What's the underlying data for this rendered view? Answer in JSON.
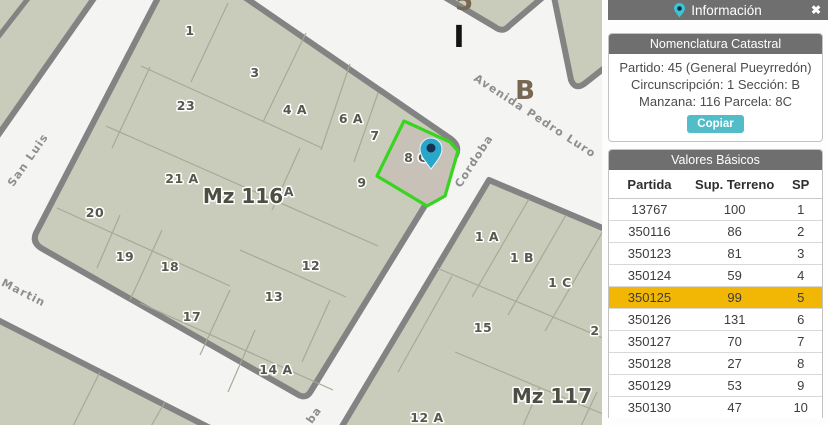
{
  "panel": {
    "header": {
      "title": "Información",
      "close_icon": "✖"
    },
    "nomenclatura": {
      "title": "Nomenclatura Catastral",
      "partido_line": "Partido: 45 (General Pueyrredón)",
      "circunscripcion_line": "Circunscripción: 1 Sección: B",
      "manzana_line": "Manzana: 116 Parcela: 8C",
      "copy_label": "Copiar"
    },
    "valores": {
      "title": "Valores Básicos",
      "columns": [
        "Partida",
        "Sup. Terreno",
        "SP"
      ],
      "rows": [
        [
          "13767",
          "100",
          "1"
        ],
        [
          "350116",
          "86",
          "2"
        ],
        [
          "350123",
          "81",
          "3"
        ],
        [
          "350124",
          "59",
          "4"
        ],
        [
          "350125",
          "99",
          "5"
        ],
        [
          "350126",
          "131",
          "6"
        ],
        [
          "350127",
          "70",
          "7"
        ],
        [
          "350128",
          "27",
          "8"
        ],
        [
          "350129",
          "53",
          "9"
        ],
        [
          "350130",
          "47",
          "10"
        ]
      ],
      "highlighted_partida": "350125"
    }
  },
  "map": {
    "selected_parcel_label": "8 C",
    "labels": [
      {
        "text": "1",
        "x": 190,
        "y": 35,
        "cls": "parcel",
        "name": "parcel-label-1"
      },
      {
        "text": "3",
        "x": 255,
        "y": 77,
        "cls": "parcel",
        "name": "parcel-label-3"
      },
      {
        "text": "23",
        "x": 186,
        "y": 110,
        "cls": "parcel",
        "name": "parcel-label-23"
      },
      {
        "text": "4 A",
        "x": 295,
        "y": 114,
        "cls": "parcel",
        "name": "parcel-label-4a"
      },
      {
        "text": "6 A",
        "x": 351,
        "y": 123,
        "cls": "parcel",
        "name": "parcel-label-6a"
      },
      {
        "text": "7",
        "x": 375,
        "y": 140,
        "cls": "parcel",
        "name": "parcel-label-7"
      },
      {
        "text": "8 C",
        "x": 416,
        "y": 162,
        "cls": "parcel",
        "name": "parcel-label-8c"
      },
      {
        "text": "9",
        "x": 362,
        "y": 187,
        "cls": "parcel",
        "name": "parcel-label-9"
      },
      {
        "text": "21 A",
        "x": 182,
        "y": 183,
        "cls": "parcel",
        "name": "parcel-label-21a"
      },
      {
        "text": "A",
        "x": 289,
        "y": 196,
        "cls": "parcel",
        "name": "parcel-label-a-partial"
      },
      {
        "text": "20",
        "x": 95,
        "y": 217,
        "cls": "parcel",
        "name": "parcel-label-20"
      },
      {
        "text": "19",
        "x": 125,
        "y": 261,
        "cls": "parcel",
        "name": "parcel-label-19"
      },
      {
        "text": "18",
        "x": 170,
        "y": 271,
        "cls": "parcel",
        "name": "parcel-label-18"
      },
      {
        "text": "12",
        "x": 311,
        "y": 270,
        "cls": "parcel",
        "name": "parcel-label-12"
      },
      {
        "text": "13",
        "x": 274,
        "y": 301,
        "cls": "parcel",
        "name": "parcel-label-13"
      },
      {
        "text": "17",
        "x": 192,
        "y": 321,
        "cls": "parcel",
        "name": "parcel-label-17"
      },
      {
        "text": "14 A",
        "x": 276,
        "y": 374,
        "cls": "parcel",
        "name": "parcel-label-14a"
      },
      {
        "text": "1 A",
        "x": 487,
        "y": 241,
        "cls": "parcel",
        "name": "parcel-label-1a"
      },
      {
        "text": "1 B",
        "x": 522,
        "y": 262,
        "cls": "parcel",
        "name": "parcel-label-1b"
      },
      {
        "text": "1 C",
        "x": 560,
        "y": 287,
        "cls": "parcel",
        "name": "parcel-label-1c"
      },
      {
        "text": "15",
        "x": 483,
        "y": 332,
        "cls": "parcel",
        "name": "parcel-label-15"
      },
      {
        "text": "2",
        "x": 595,
        "y": 335,
        "cls": "parcel",
        "name": "parcel-label-2"
      },
      {
        "text": "12 A",
        "x": 427,
        "y": 422,
        "cls": "parcel",
        "name": "parcel-label-12a"
      },
      {
        "text": "Mz 116",
        "x": 243,
        "y": 203,
        "cls": "block",
        "name": "block-label-mz116"
      },
      {
        "text": "Mz 117",
        "x": 552,
        "y": 403,
        "cls": "block",
        "name": "block-label-mz117"
      },
      {
        "text": "I",
        "x": 459,
        "y": 47,
        "cls": "section-i",
        "name": "section-label-i"
      },
      {
        "text": "B",
        "x": 525,
        "y": 99,
        "cls": "section-b",
        "name": "section-label-b"
      },
      {
        "text": "5",
        "x": 464,
        "y": 10,
        "cls": "section-b",
        "name": "section-label-partial"
      },
      {
        "text": "San Luis",
        "x": 31,
        "y": 162,
        "rotate": -55,
        "cls": "street",
        "name": "street-label-san-luis"
      },
      {
        "text": "Martin",
        "x": 22,
        "y": 296,
        "rotate": 27,
        "cls": "street",
        "name": "street-label-martin"
      },
      {
        "text": "Avenida Pedro Luro",
        "x": 533,
        "y": 119,
        "rotate": 33,
        "cls": "street",
        "name": "street-label-avenida-pedro-luro"
      },
      {
        "text": "Cordoba",
        "x": 477,
        "y": 163,
        "rotate": -57,
        "cls": "street",
        "name": "street-label-cordoba"
      },
      {
        "text": "ba",
        "x": 317,
        "y": 417,
        "rotate": -55,
        "cls": "street",
        "name": "street-label-partial"
      }
    ],
    "colors": {
      "parcel_fill": "#c9ccba",
      "selected_parcel_fill": "#c8c1b8",
      "selection_green": "#38d41f",
      "street_casing": "#838383",
      "pin_teal": "#2aa6cb",
      "panel_header_bg": "#6f6f6f",
      "accent_teal": "#52bdc9",
      "highlight_yellow": "#f2b705"
    }
  }
}
